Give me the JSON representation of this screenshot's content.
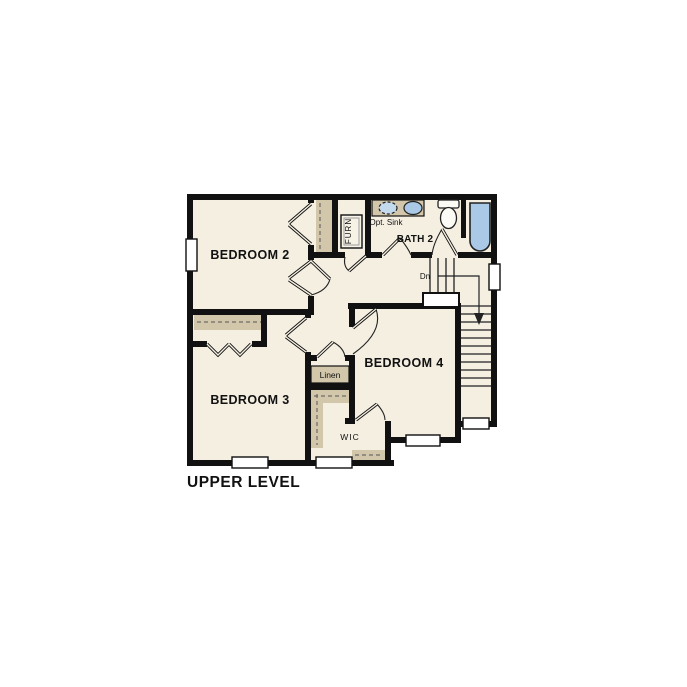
{
  "title": "UPPER LEVEL",
  "rooms": {
    "bedroom2": "BEDROOM 2",
    "bedroom3": "BEDROOM 3",
    "bedroom4": "BEDROOM 4",
    "bath2": "BATH 2"
  },
  "labels": {
    "furnace": "FURN",
    "opt_sink": "Opt. Sink",
    "linen": "Linen",
    "wic": "WIC",
    "stairs_down": "Dn"
  },
  "colors": {
    "background": "#ffffff",
    "wall": "#111111",
    "floor": "#f5efe2",
    "casework": "#d3c7ab",
    "fixture_blue": "#a9c9e6",
    "fixture_blue_light": "#c3d9ec",
    "line": "#222222",
    "text": "#111111",
    "white": "#ffffff"
  }
}
